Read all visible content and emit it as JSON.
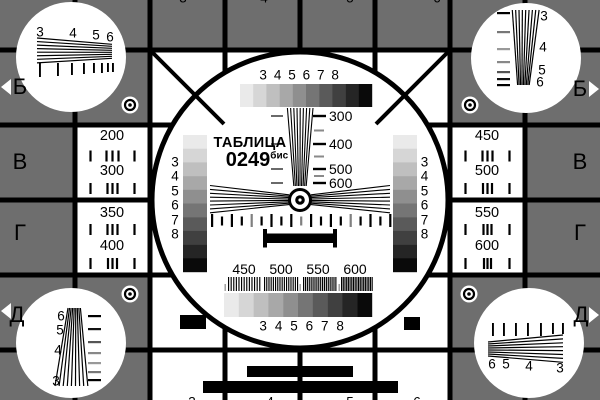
{
  "card": {
    "title": "ТАБЛИЦА",
    "code": "0249",
    "code_suffix": "бис",
    "colors": {
      "background": "#6e6e6e",
      "panel": "#ffffff",
      "foreground": "#000000",
      "grayscale_steps": [
        "#eaeaea",
        "#d6d6d6",
        "#bfbfbf",
        "#a8a8a8",
        "#8f8f8f",
        "#757575",
        "#5a5a5a",
        "#404040",
        "#252525",
        "#0a0a0a"
      ]
    },
    "row_letters": [
      "Б",
      "В",
      "Г",
      "Д"
    ],
    "edge_digits_top": [
      "3",
      "4",
      "5",
      "6"
    ],
    "edge_digits_bottom": [
      "3",
      "4",
      "5",
      "6"
    ],
    "grayscale_labels": [
      "3",
      "4",
      "5",
      "6",
      "7",
      "8"
    ],
    "left_panel_values": [
      "200",
      "300",
      "350",
      "400"
    ],
    "right_panel_values": [
      "450",
      "500",
      "550",
      "600"
    ],
    "center_wedge_labels": [
      "300",
      "400",
      "500",
      "600"
    ],
    "bottom_freq_labels": [
      "450",
      "500",
      "550",
      "600"
    ],
    "corner_labels": {
      "top_left": [
        "3",
        "4",
        "5",
        "6"
      ],
      "top_right": [
        "3",
        "4",
        "5",
        "6"
      ],
      "bottom_left": [
        "6",
        "5",
        "4",
        "3"
      ],
      "bottom_right": [
        "6",
        "5",
        "4",
        "3"
      ]
    }
  }
}
